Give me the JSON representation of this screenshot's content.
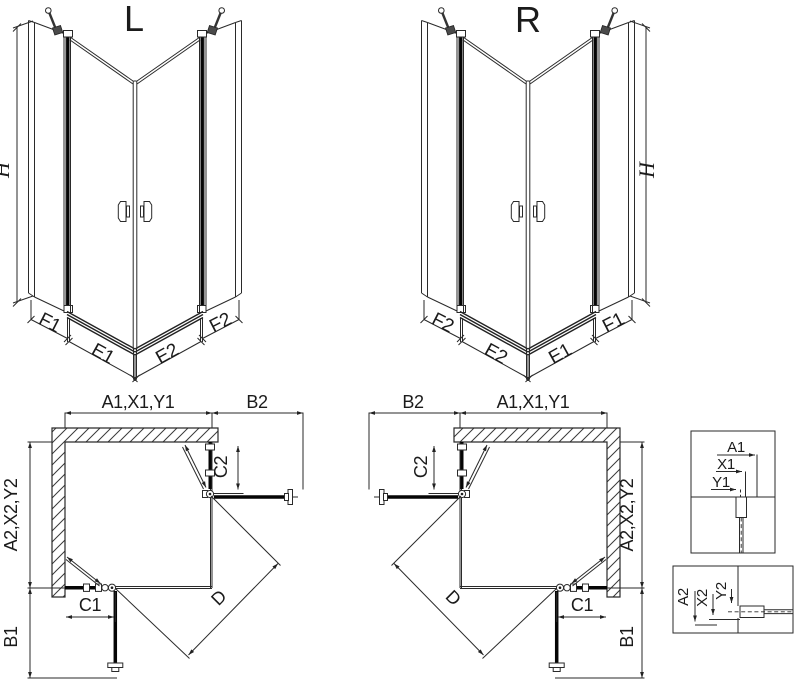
{
  "left_view": {
    "label": "L",
    "height_label": "H",
    "segment_labels": [
      "F1",
      "E1",
      "E2",
      "F2"
    ]
  },
  "right_view": {
    "label": "R",
    "height_label": "H",
    "segment_labels": [
      "F2",
      "E2",
      "E1",
      "F1"
    ]
  },
  "left_plan": {
    "top_label": "A1,X1,Y1",
    "top_right_label": "B2",
    "left_label": "A2,X2,Y2",
    "bottom_left_label": "B1",
    "door_top_label": "C2",
    "door_bottom_label": "C1",
    "diagonal_label": "D"
  },
  "right_plan": {
    "top_left_label": "B2",
    "top_label": "A1,X1,Y1",
    "right_label": "A2,X2,Y2",
    "bottom_right_label": "B1",
    "door_top_label": "C2",
    "door_bottom_label": "C1",
    "diagonal_label": "D"
  },
  "detail_top": {
    "labels": [
      "A1",
      "X1",
      "Y1"
    ]
  },
  "detail_bottom": {
    "labels": [
      "A2",
      "X2",
      "Y2"
    ]
  },
  "colors": {
    "line": "#222222",
    "glass": "#050505",
    "background": "#ffffff"
  }
}
